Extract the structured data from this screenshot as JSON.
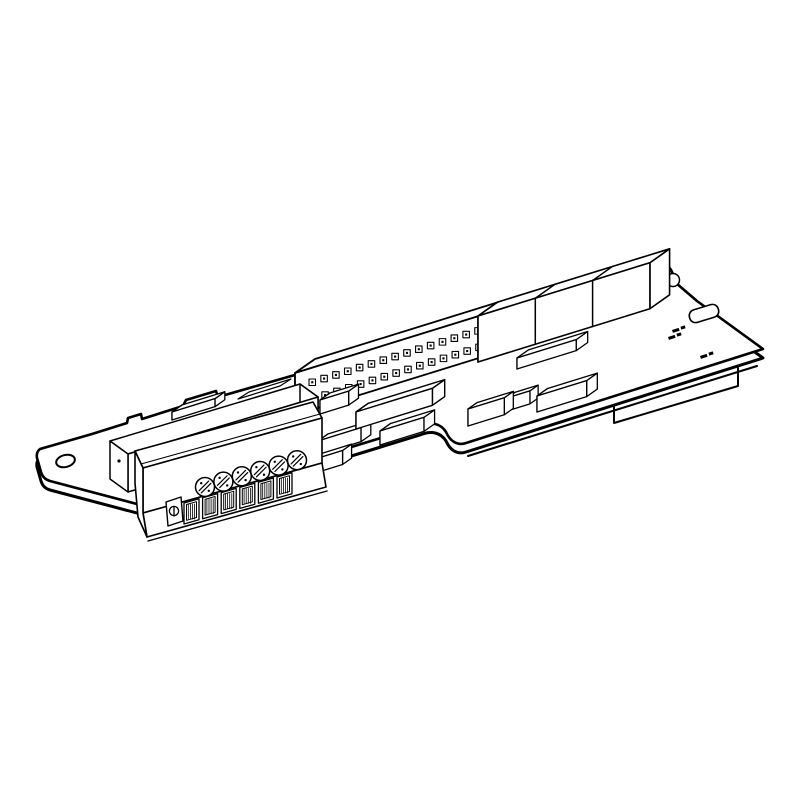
{
  "meta": {
    "type": "technical-line-illustration",
    "subject": "Isometric line drawing of a plug-in electronic option card (PCB) with screw terminal block",
    "background_color": "#ffffff",
    "line_color": "#000000"
  },
  "illustration": {
    "board": {
      "mounting_tab_holes": 1,
      "ear_holes": 1,
      "keying_notches": 1,
      "edge_connector_tabs": 1,
      "back_edge_bumps": 2
    },
    "terminal_block": {
      "screw_terminals": 6,
      "wire_openings": 6
    },
    "pin_header": {
      "rows": 2,
      "columns": 25
    },
    "ic_row": {
      "count": 3
    },
    "component_blocks": {
      "count": 10
    },
    "silkscreen": {
      "mark_clusters": 3
    }
  }
}
